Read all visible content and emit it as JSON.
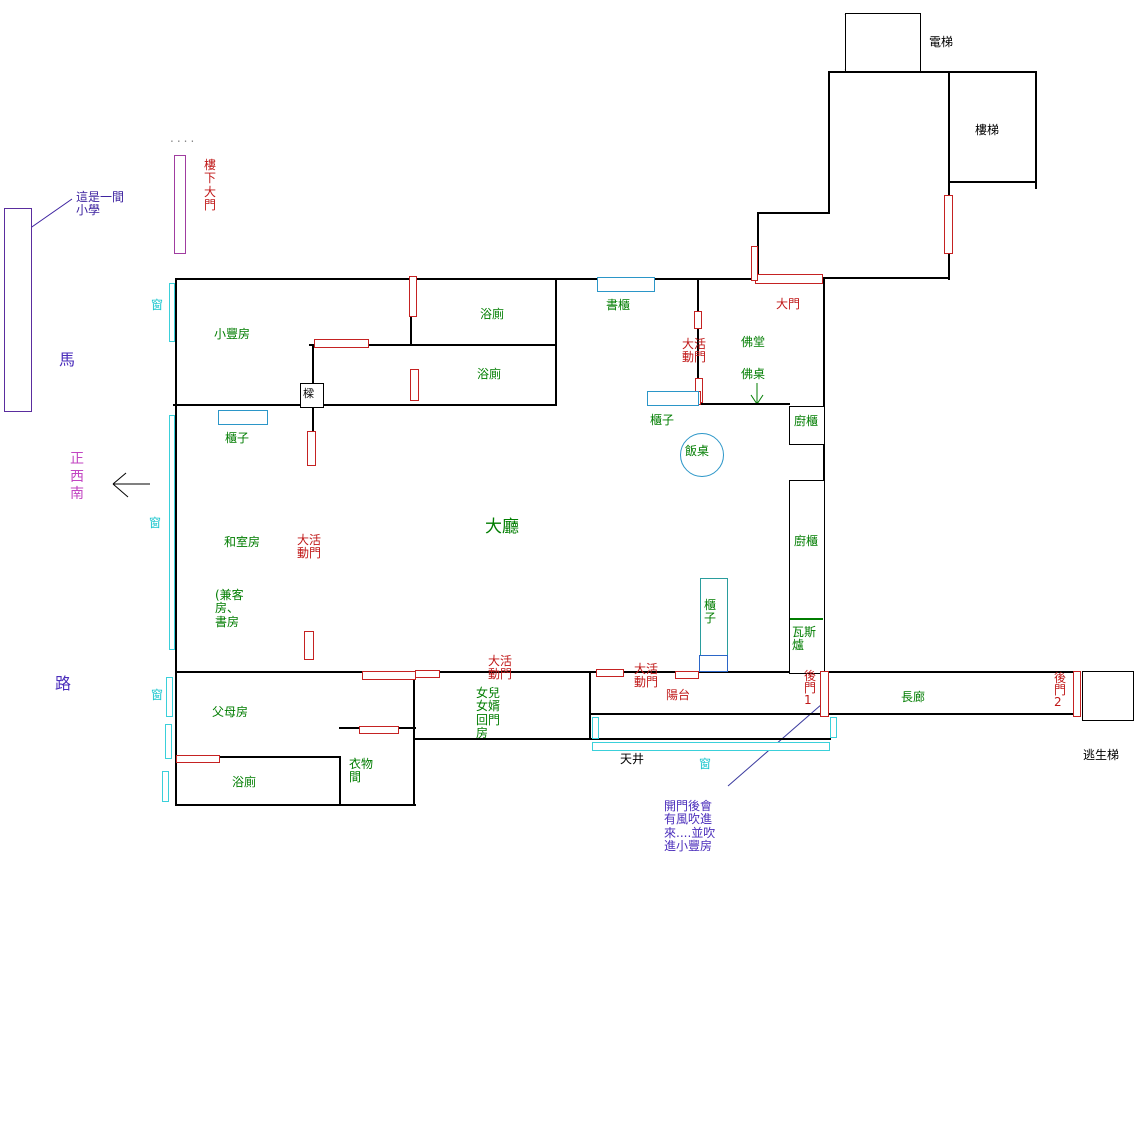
{
  "colors": {
    "wall": "#000000",
    "door": "#c52222",
    "window": "#3ad0da",
    "furniture": "#2b96c8",
    "room_label": "#007d00",
    "door_label": "#c01818",
    "window_label": "#19c5cd",
    "note_purple": "#4a2dbb",
    "direction_magenta": "#c245c2"
  },
  "labels": {
    "elevator": "電梯",
    "stairs": "樓梯",
    "downstairs_door": "樓\n下\n大\n門",
    "dots": "....",
    "school_note": "這是一間\n小學",
    "road_char1": "馬",
    "road_char2": "路",
    "direction": "正\n西\n南",
    "window1": "窗",
    "window2": "窗",
    "window3": "窗",
    "window4": "窗",
    "xiaofeng_room": "小豐房",
    "bathroom1": "浴廁",
    "bathroom2": "浴廁",
    "bathroom3": "浴廁",
    "bookcase": "書櫃",
    "main_door": "大門",
    "movable_door1": "大活\n動門",
    "movable_door2": "大活\n動門",
    "movable_door3": "大活\n動門",
    "movable_door4": "大活\n動門",
    "buddha_hall": "佛堂",
    "buddha_table": "佛桌",
    "cabinet1": "櫃子",
    "cabinet2": "櫃子",
    "cabinet_tall": "櫃\n子",
    "kitchen_cabinet1": "廚櫃",
    "kitchen_cabinet2": "廚櫃",
    "gas_stove": "瓦斯\n爐",
    "dining_table": "飯桌",
    "beam": "樑",
    "living_room": "大廳",
    "tatami_room": "和室房",
    "guest_study_note": "(兼客\n房、\n書房",
    "parents_room": "父母房",
    "closet_room": "衣物\n間",
    "daughter_note": "女兒\n女婿\n回門\n房",
    "balcony": "陽台",
    "back_door1": "後\n門\n1",
    "back_door2": "後\n門\n2",
    "courtyard": "天井",
    "corridor": "長廊",
    "escape_stairs": "逃生梯",
    "wind_note": "開門後會\n有風吹進\n來....並吹\n進小豐房"
  }
}
